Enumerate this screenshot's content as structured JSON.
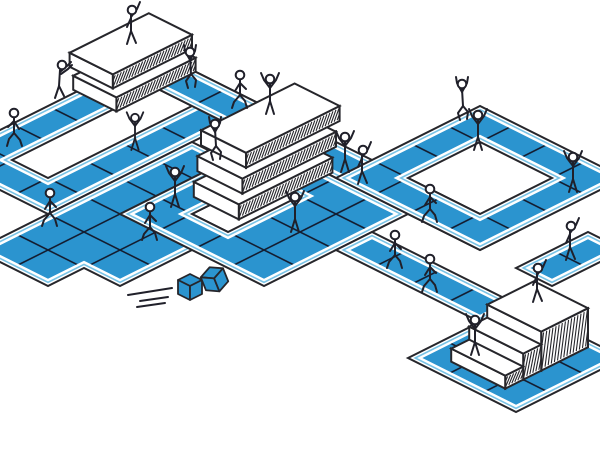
{
  "scene": {
    "width": 600,
    "height": 450,
    "background": "#ffffff"
  },
  "palette": {
    "path_blue": "#2B94CF",
    "accent_blue": "#78C3E6",
    "outline_dark": "#26262B",
    "tile_line": "#141E32",
    "surface_white": "#ffffff",
    "figure_stroke": "#20202A",
    "cube_blue": "#2B94CF"
  },
  "iso": {
    "origin": [
      -60,
      160
    ],
    "axis_a": [
      36,
      18
    ],
    "axis_b": [
      36,
      -18
    ],
    "margin_accent": 0.1,
    "margin_blue": 0.2
  },
  "regions": [
    {
      "name": "left-loop",
      "outer": [
        [
          0,
          0
        ],
        [
          0,
          6
        ],
        [
          3,
          6
        ],
        [
          3,
          0
        ]
      ],
      "holes": [
        [
          [
            1,
            1
          ],
          [
            1,
            5
          ],
          [
            2,
            5
          ],
          [
            2,
            1
          ]
        ]
      ]
    },
    {
      "name": "bottom-left-area",
      "outer": [
        [
          3,
          -2
        ],
        [
          3,
          4
        ],
        [
          5,
          4
        ],
        [
          5,
          2
        ],
        [
          6,
          2
        ],
        [
          6,
          -1
        ],
        [
          5,
          -1
        ],
        [
          5,
          -2
        ]
      ],
      "holes": []
    },
    {
      "name": "top-band",
      "outer": [
        [
          0,
          5
        ],
        [
          0,
          6
        ],
        [
          10,
          6
        ],
        [
          10,
          5
        ]
      ],
      "holes": []
    },
    {
      "name": "center-loop",
      "outer": [
        [
          4,
          1
        ],
        [
          4,
          5
        ],
        [
          8,
          5
        ],
        [
          8,
          1
        ]
      ],
      "holes": [
        [
          [
            5,
            2
          ],
          [
            5,
            4
          ],
          [
            6,
            4
          ],
          [
            6,
            2
          ]
        ]
      ]
    },
    {
      "name": "right-loop",
      "outer": [
        [
          6,
          5
        ],
        [
          6,
          9
        ],
        [
          10,
          9
        ],
        [
          10,
          5
        ]
      ],
      "holes": [
        [
          [
            7,
            6
          ],
          [
            7,
            8
          ],
          [
            9,
            8
          ],
          [
            9,
            6
          ]
        ]
      ]
    },
    {
      "name": "lower-band",
      "outer": [
        [
          8,
          3
        ],
        [
          8,
          4
        ],
        [
          12,
          4
        ],
        [
          12,
          3
        ]
      ],
      "holes": []
    },
    {
      "name": "stair-pad",
      "outer": [
        [
          12,
          1
        ],
        [
          12,
          4
        ],
        [
          15,
          4
        ],
        [
          15,
          1
        ]
      ],
      "holes": []
    },
    {
      "name": "right-pad",
      "outer": [
        [
          11,
          5
        ],
        [
          11,
          7
        ],
        [
          12,
          7
        ],
        [
          12,
          5
        ]
      ],
      "holes": []
    }
  ],
  "podiums": [
    {
      "name": "podium-top-left",
      "slabs": [
        {
          "u": -0.1,
          "v": 3.8,
          "du": 1.2,
          "dv": 2.2,
          "z": 14,
          "t": 14
        },
        {
          "u": -0.4,
          "v": 4.0,
          "du": 1.2,
          "dv": 2.2,
          "z": 28,
          "t": 14
        }
      ]
    },
    {
      "name": "podium-center",
      "slabs": [
        {
          "u": 4.55,
          "v": 2.5,
          "du": 1.25,
          "dv": 2.6,
          "z": 15,
          "t": 15
        },
        {
          "u": 4.3,
          "v": 2.85,
          "du": 1.25,
          "dv": 2.6,
          "z": 30,
          "t": 15
        },
        {
          "u": 4.05,
          "v": 3.2,
          "du": 1.25,
          "dv": 2.6,
          "z": 45,
          "t": 15
        }
      ]
    },
    {
      "name": "podium-stairs",
      "slabs": [
        {
          "u": 12.7,
          "v": 2.5,
          "du": 1.5,
          "dv": 1.3,
          "z": 39,
          "t": 39
        },
        {
          "u": 12.7,
          "v": 2.0,
          "du": 1.5,
          "dv": 0.5,
          "z": 26,
          "t": 26
        },
        {
          "u": 12.7,
          "v": 1.5,
          "du": 1.5,
          "dv": 0.5,
          "z": 13,
          "t": 13
        }
      ]
    }
  ],
  "figures": [
    {
      "pose": "flag",
      "x": 131,
      "y": 44
    },
    {
      "pose": "climb",
      "x": 190,
      "y": 88
    },
    {
      "pose": "push",
      "x": 60,
      "y": 98
    },
    {
      "pose": "walk",
      "x": 14,
      "y": 146,
      "flip": true
    },
    {
      "pose": "walk",
      "x": 50,
      "y": 226
    },
    {
      "pose": "walk",
      "x": 150,
      "y": 240
    },
    {
      "pose": "cheer",
      "x": 135,
      "y": 150,
      "scale": 0.92
    },
    {
      "pose": "cheer",
      "x": 175,
      "y": 207
    },
    {
      "pose": "climb",
      "x": 215,
      "y": 160
    },
    {
      "pose": "cheer",
      "x": 270,
      "y": 114
    },
    {
      "pose": "walk",
      "x": 240,
      "y": 108
    },
    {
      "pose": "cheer",
      "x": 295,
      "y": 232
    },
    {
      "pose": "cheer",
      "x": 345,
      "y": 172
    },
    {
      "pose": "flag",
      "x": 362,
      "y": 184
    },
    {
      "pose": "climb",
      "x": 462,
      "y": 120
    },
    {
      "pose": "cheer",
      "x": 478,
      "y": 150
    },
    {
      "pose": "cheer",
      "x": 573,
      "y": 192
    },
    {
      "pose": "flag",
      "x": 570,
      "y": 260
    },
    {
      "pose": "walk",
      "x": 395,
      "y": 268
    },
    {
      "pose": "walk",
      "x": 430,
      "y": 292
    },
    {
      "pose": "walk",
      "x": 430,
      "y": 222
    },
    {
      "pose": "cheer",
      "x": 475,
      "y": 355
    },
    {
      "pose": "flag",
      "x": 537,
      "y": 302
    }
  ],
  "cubes": [
    {
      "x": 190,
      "y": 291,
      "rotation": 0
    },
    {
      "x": 216,
      "y": 283,
      "rotation": -22
    }
  ],
  "speed_lines": [
    [
      128,
      295,
      172,
      288
    ],
    [
      140,
      301,
      168,
      297
    ],
    [
      137,
      307,
      165,
      303
    ]
  ]
}
